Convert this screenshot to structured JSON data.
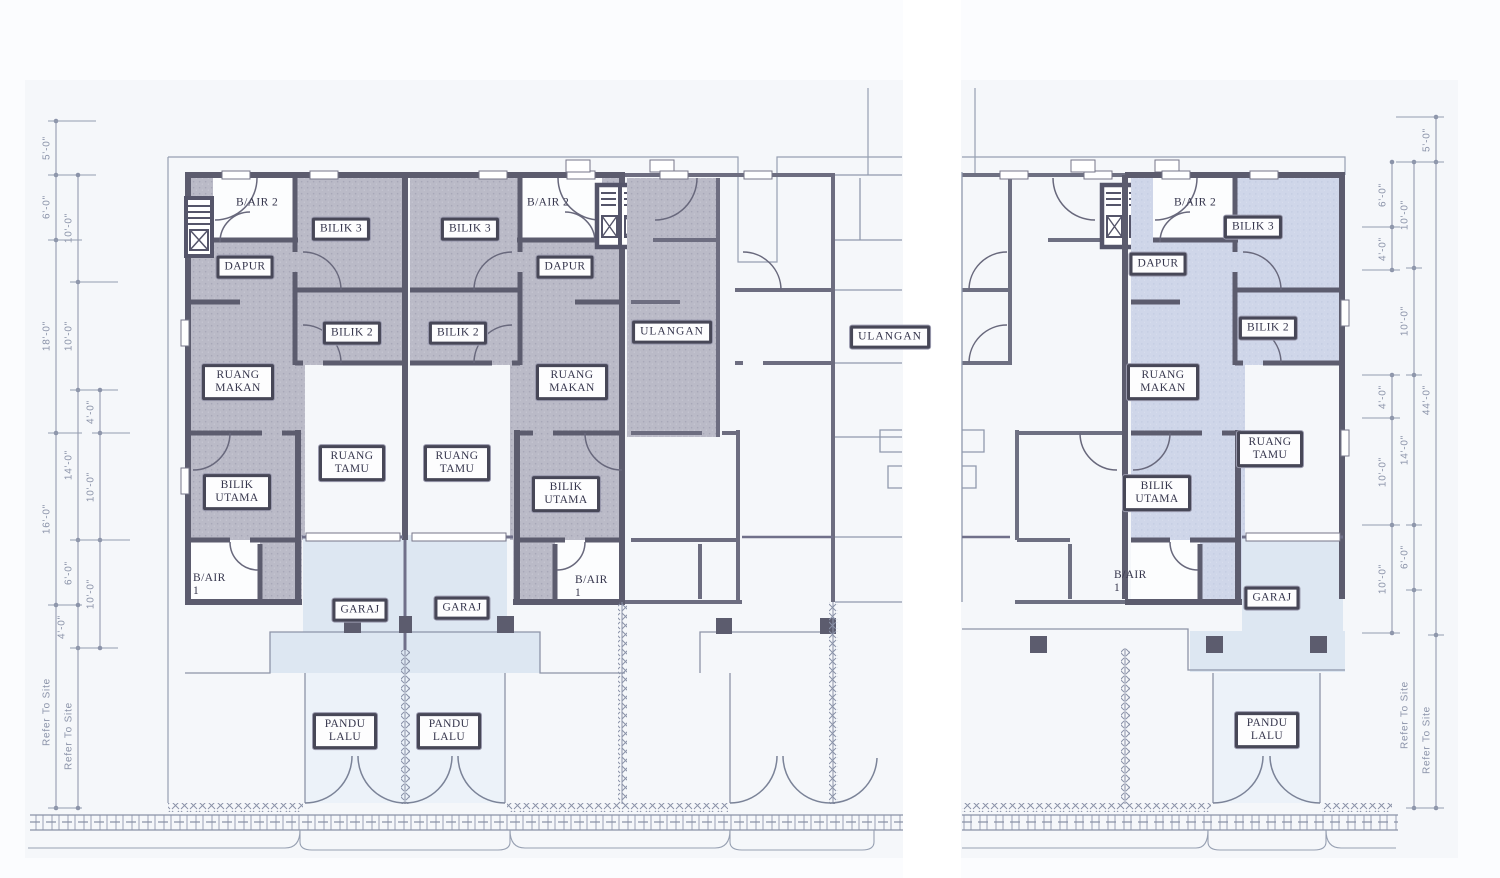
{
  "drawing": {
    "kind": "terrace-house floor plan",
    "units": {
      "u1": {
        "bair2": "B/AIR 2",
        "bilik3": "BILIK 3",
        "dapur": "DAPUR",
        "bilik2": "BILIK 2",
        "ruang_makan": "RUANG MAKAN",
        "ruang_tamu": "RUANG TAMU",
        "bilik_utama": "BILIK UTAMA",
        "bair1": "B/AIR 1",
        "garaj": "GARAJ",
        "pandu_lalu": "PANDU LALU"
      },
      "u2": {
        "bair2": "B/AIR 2",
        "bilik3": "BILIK 3",
        "dapur": "DAPUR",
        "bilik2": "BILIK 2",
        "ruang_makan": "RUANG MAKAN",
        "ruang_tamu": "RUANG TAMU",
        "bilik_utama": "BILIK UTAMA",
        "bair1": "B/AIR 1",
        "garaj": "GARAJ",
        "pandu_lalu": "PANDU LALU"
      },
      "u3": {
        "ulangan": "ULANGAN"
      },
      "u4": {
        "ulangan": "ULANGAN"
      },
      "u6": {
        "bair2": "B/AIR 2",
        "bilik3": "BILIK 3",
        "dapur": "DAPUR",
        "bilik2": "BILIK 2",
        "ruang_makan": "RUANG MAKAN",
        "ruang_tamu": "RUANG TAMU",
        "bilik_utama": "BILIK UTAMA",
        "bair1": "B/AIR 1",
        "garaj": "GARAJ",
        "pandu_lalu": "PANDU LALU"
      }
    },
    "dimensions": {
      "left_outer": [
        "5'-0\"",
        "6'-0\"",
        "18'-0\"",
        "16'-0\"",
        "Refer To Site"
      ],
      "left_middle": [
        "10'-0\"",
        "10'-0\"",
        "14'-0\"",
        "6'-0\"",
        "4'-0\"",
        "Refer To Site"
      ],
      "left_inner": [
        "4'-0\"",
        "10'-0\"",
        "10'-0\""
      ],
      "right_inner": [
        "6'-0\"",
        "4'-0\"",
        "4'-0\"",
        "10'-0\"",
        "10'-0\""
      ],
      "right_middle": [
        "10'-0\"",
        "10'-0\"",
        "14'-0\"",
        "6'-0\"",
        "Refer To Site"
      ],
      "right_outer": [
        "5'-0\"",
        "44'-0\"",
        "Refer To Site"
      ]
    },
    "colors": {
      "wall": "#5c5c6e",
      "shaded_room": "#babac7",
      "blue_room": "#cdd5e9",
      "garage_tint": "#dde7f2",
      "driveway_tint": "#ecf2f9",
      "paper": "#f5f7fa",
      "dimension": "#8b93a9",
      "label_border": "#474757"
    }
  }
}
